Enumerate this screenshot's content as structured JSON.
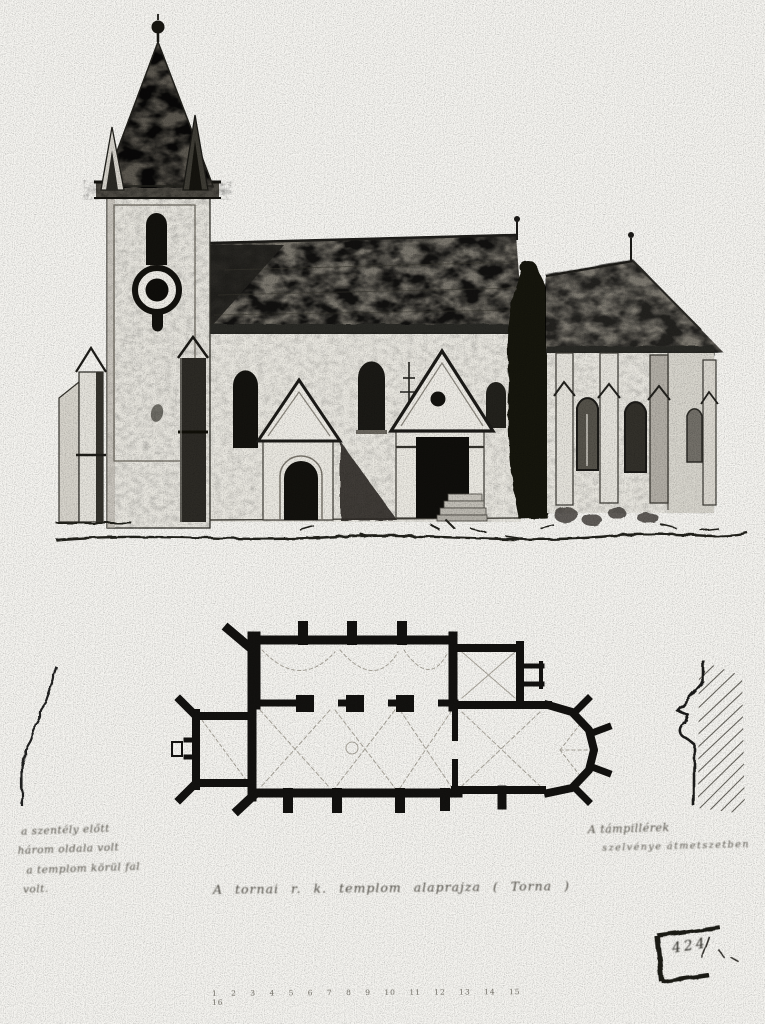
{
  "palette": {
    "paper": "#f6f5f1",
    "ink": "#1c1b18",
    "wash": "#8a867e"
  },
  "annotations": {
    "left_note": {
      "lines": [
        "a szentély előtt",
        "három oldala volt",
        "a templom körül fal",
        "volt."
      ]
    },
    "right_note": {
      "lines": [
        "A támpillérek",
        "szelvénye átmetszetben"
      ]
    },
    "caption": "A tornai r. k. templom alaprajza ( Torna )",
    "stamp_number": "424",
    "scale_numbers": "1 2 3 4 5 6 7 8 9 10 11 12 13 14 15 16"
  }
}
